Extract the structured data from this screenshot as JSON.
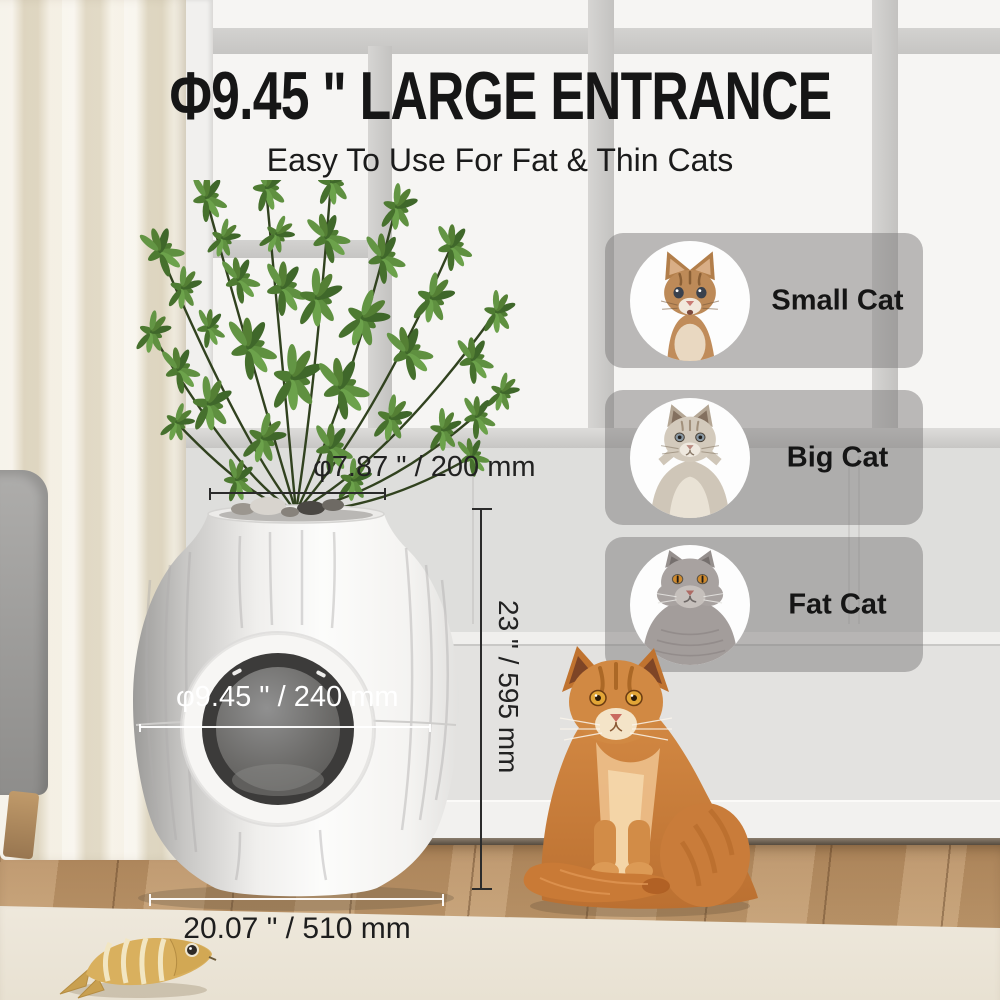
{
  "headline": {
    "title": "Φ9.45 \" LARGE ENTRANCE",
    "subtitle": "Easy To Use For Fat & Thin Cats"
  },
  "size_cards": {
    "items": [
      {
        "label": "Small Cat",
        "photo": "kitten-photo"
      },
      {
        "label": "Big Cat",
        "photo": "big-cat-photo"
      },
      {
        "label": "Fat Cat",
        "photo": "fat-cat-photo"
      }
    ]
  },
  "dimensions": {
    "top_opening": "φ7.87 \" / 200 mm",
    "entrance": "φ9.45 \" / 240 mm",
    "height": "23 \" / 595 mm",
    "base_width": "20.07 \" / 510 mm"
  },
  "colors": {
    "headline_text": "#161616",
    "card_background": "rgba(125,124,123,0.5)",
    "card_label_text": "#151515",
    "dimension_dark": "#2b2b2b",
    "dimension_light": "#ffffff",
    "accent_green": "#5b8539",
    "box_white": "#fafaf9",
    "cat_orange": "#d08440"
  }
}
